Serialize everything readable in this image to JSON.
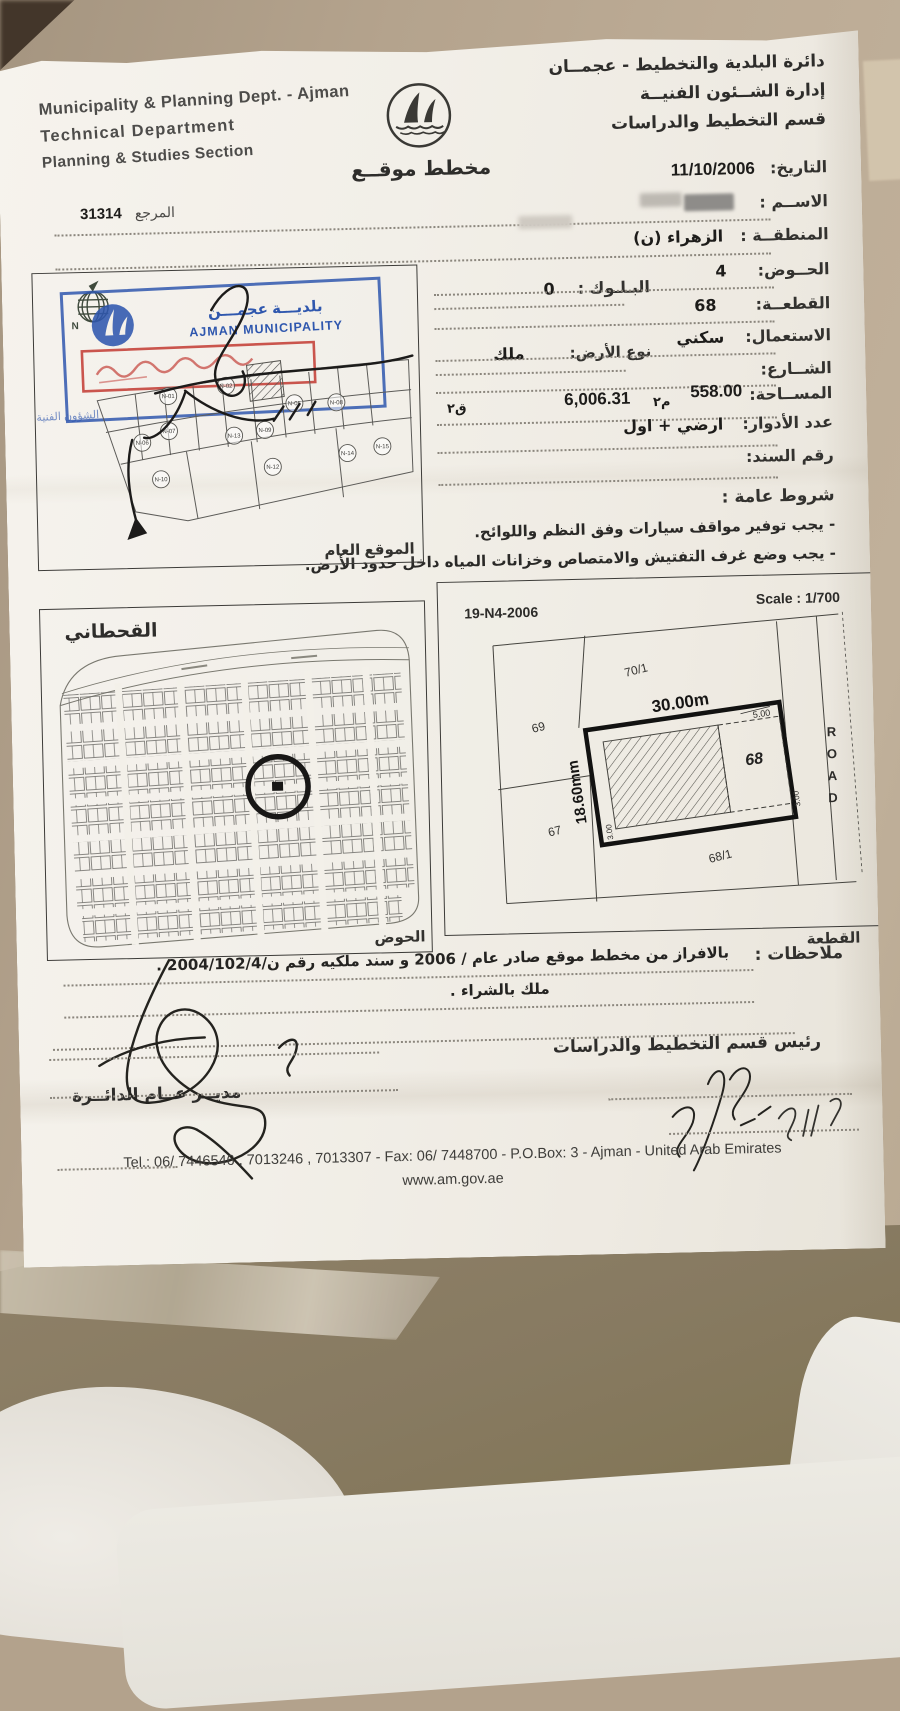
{
  "page": {
    "header_left": {
      "line1": "Municipality & Planning Dept. - Ajman",
      "line2": "Technical Department",
      "line3": "Planning & Studies Section"
    },
    "header_right": {
      "line1": "دائرة البلدية والتخطيط - عجمــان",
      "line2": "إدارة الشــئون الفنيــة",
      "line3": "قسم التخطيط والدراسات"
    },
    "title_ar": "مخطط موقــع",
    "date_label": "التاريخ:",
    "date_value": "11/10/2006",
    "ref_label": "المرجع",
    "ref_value": "31314"
  },
  "fields": {
    "name_label": "الاســم :",
    "area_label": "المنطقــة :",
    "area_value": "الزهراء (ن)",
    "basin_label": "الحــوض:",
    "basin_value": "4",
    "block_label": "البـلـوك :",
    "block_value": "0",
    "plot_label": "القطعــة:",
    "plot_value": "68",
    "use_label": "الاستعمال:",
    "use_value": "سكني",
    "landtype_label": "نوع الأرض:",
    "landtype_value": "ملك",
    "street_label": "الشــارع:",
    "size_label": "المســاحة:",
    "size_m": "558.00",
    "unit_m": "م٢",
    "size_ft": "6,006.31",
    "unit_ft": "ق٢",
    "floors_label": "عدد الأدوار:",
    "floors_value": "ارضي + اول",
    "deed_label": "رقم السند:",
    "conditions_title": "شروط عامة :",
    "condition1": "- يجب توفير مواقف سيارات وفق النظم واللوائح.",
    "condition2": "- يجب وضع غرف التفتيش والامتصاص وخزانات المياه داخل حدود الأرض."
  },
  "general_map": {
    "stamp_ar": "بلديـــة عجمـــن",
    "stamp_en": "AJMAN MUNICIPALITY",
    "stamp_sub": "الشؤون الفنية",
    "compass": "N",
    "caption": "الموقع العام",
    "plots": [
      "N-01",
      "N-02",
      "N-05",
      "N-06",
      "N-07",
      "N-08",
      "N-09",
      "N-10",
      "N-12",
      "N-13",
      "N-14",
      "N-15"
    ]
  },
  "district_map": {
    "title": "القحطاني",
    "caption": "الحوض"
  },
  "plot_map": {
    "ref": "19-N4-2006",
    "scale": "Scale : 1/700",
    "caption": "القطعة",
    "width_dim": "30.00m",
    "depth_dim": "18.60mm",
    "dim_5": "5.00",
    "dim_3a": "3.00",
    "dim_3b": "3.00",
    "plot_number": "68",
    "n_left": "69",
    "n_top": "70/1",
    "n_bottom_left": "67",
    "n_bottom": "68/1",
    "road": "ROAD"
  },
  "notes": {
    "label": "ملاحظات :",
    "line1": "بالافراز من مخطط موقع صادر عام / 2006 و سند ملكيه رقم ن/2004/102/4 .",
    "line2": "ملك بالشراء ."
  },
  "signatures": {
    "right_title": "رئيس قسم التخطيط والدراسات",
    "left_title": "مديــر عــام الدائــرة"
  },
  "footer": {
    "line1": "Tel.: 06/ 7446546 , 7013246 , 7013307 - Fax: 06/ 7448700 - P.O.Box: 3 - Ajman - United Arab Emirates",
    "line2": "www.am.gov.ae"
  }
}
